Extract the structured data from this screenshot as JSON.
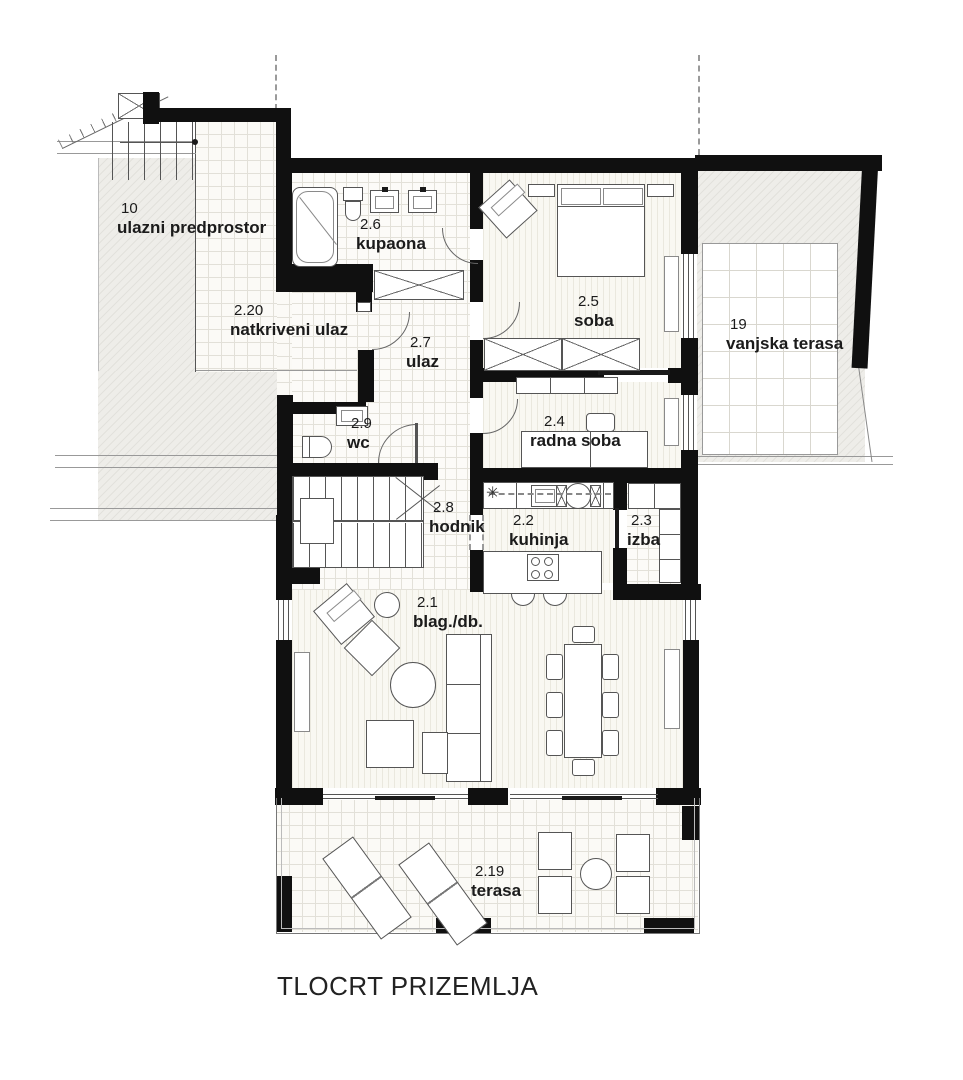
{
  "title": "TLOCRT PRIZEMLJA",
  "rooms": [
    {
      "id": "10",
      "name": "ulazni predprostor"
    },
    {
      "id": "2.20",
      "name": "natkriveni ulaz"
    },
    {
      "id": "2.6",
      "name": "kupaona"
    },
    {
      "id": "2.5",
      "name": "soba"
    },
    {
      "id": "19",
      "name": "vanjska terasa"
    },
    {
      "id": "2.7",
      "name": "ulaz"
    },
    {
      "id": "2.9",
      "name": "wc"
    },
    {
      "id": "2.4",
      "name": "radna soba"
    },
    {
      "id": "2.8",
      "name": "hodnik"
    },
    {
      "id": "2.2",
      "name": "kuhinja"
    },
    {
      "id": "2.3",
      "name": "izba"
    },
    {
      "id": "2.1",
      "name": "blag./db."
    },
    {
      "id": "2.19",
      "name": "terasa"
    }
  ],
  "symbols": {
    "kitchen_fixture": "✳"
  },
  "colors": {
    "wall": "#101010",
    "line": "#555555",
    "text": "#1b1b1b",
    "floor": "#f9f8f2"
  }
}
